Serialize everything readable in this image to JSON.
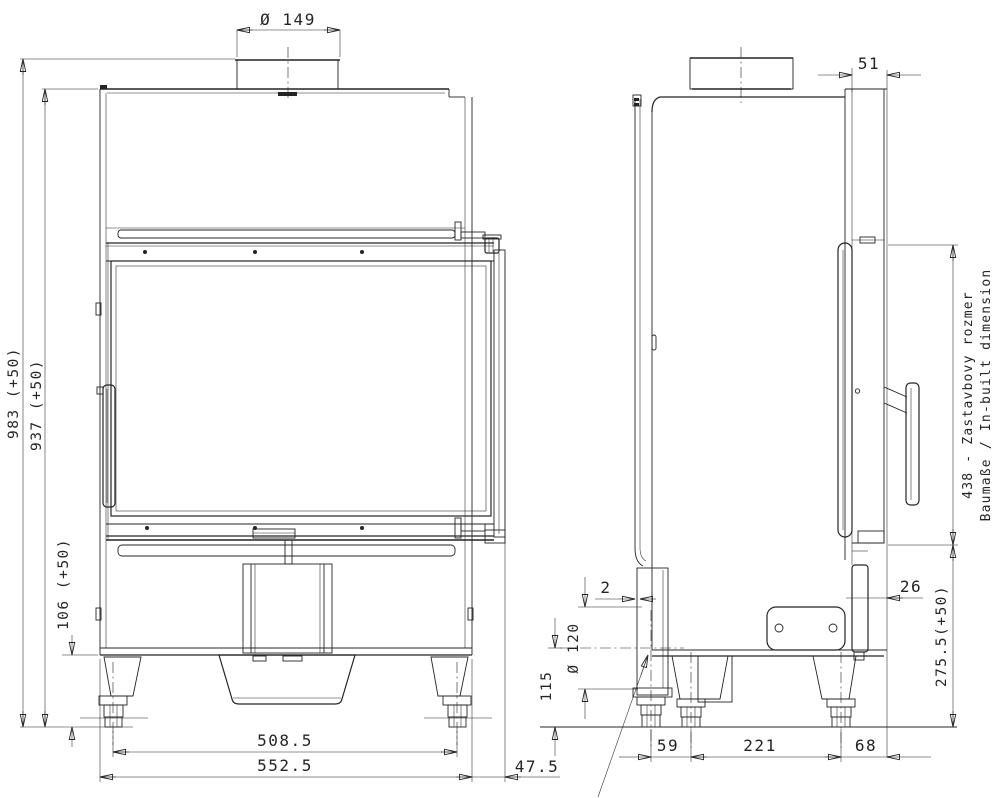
{
  "drawing": {
    "type": "fireplace-insert dimensional drawing, front and left-side orthographic views",
    "colors": {
      "ink": "#242424",
      "paper": "#ffffff"
    },
    "dims": {
      "flue_diameter": "Ø 149",
      "total_height": "983 (+50)",
      "body_height": "937 (+50)",
      "base_height": "106 (+50)",
      "feet_spacing": "508.5",
      "overall_width": "552.5",
      "door_side_offset": "47.5",
      "front_frame_depth": "51",
      "inbuilt_height_cz": "438 - Zastavbovy rozmer",
      "inbuilt_height_en": "Baumaße / In-built dimension",
      "bottom_inbuilt_height": "275.5(+50)",
      "lower_panel_setback": "26",
      "rear_gap": "2",
      "air_intake_diameter": "Ø 120",
      "air_intake_center_height": "115",
      "rear_foot_spacing": "59",
      "mid_foot_spacing": "221",
      "front_foot_offset": "68"
    }
  }
}
